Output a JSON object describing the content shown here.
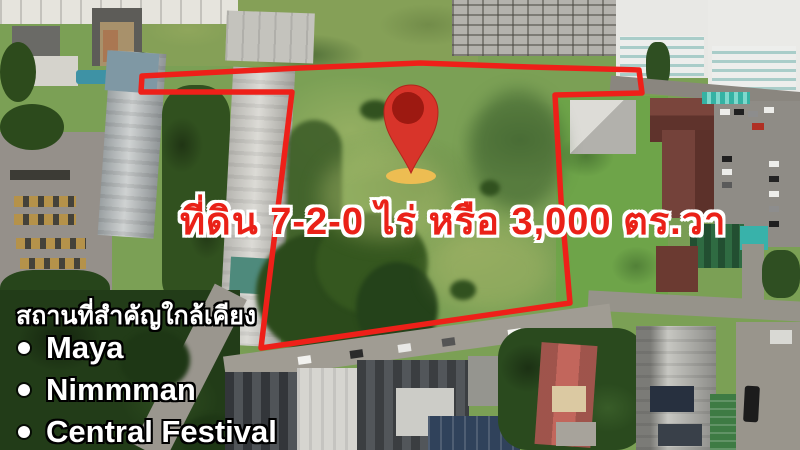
{
  "listing": {
    "area_label": "ที่ดิน 7-2-0 ไร่ หรือ 3,000 ตร.วา",
    "nearby_title": "สถานที่สำคัญใกล้เคียง",
    "nearby_places": [
      "Maya",
      "Nimmman",
      "Central Festival"
    ]
  },
  "marker": {
    "type": "location-pin"
  },
  "colors": {
    "boundary": "#ee2019",
    "label_fill": "#ea2118",
    "label_outline": "#ffffff",
    "nearby_fill": "#ffffff",
    "nearby_outline": "#000000",
    "pin_body": "#d8342a",
    "pin_inner": "#9d1911",
    "pin_base": "#edbd52"
  }
}
